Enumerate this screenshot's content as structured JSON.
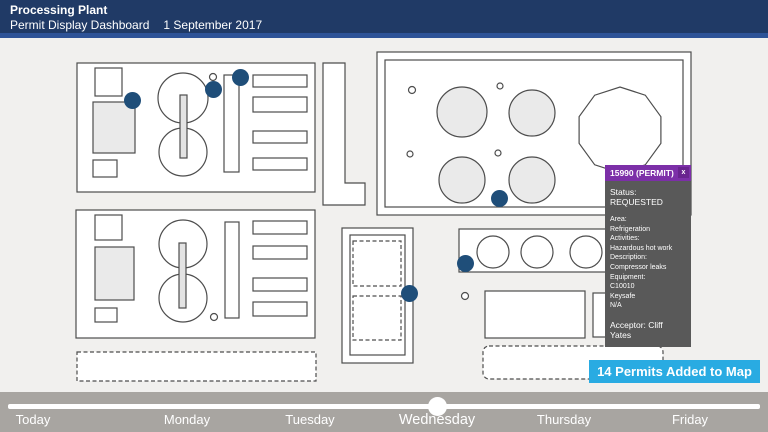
{
  "header": {
    "title": "Processing Plant",
    "subtitle": "Permit Display Dashboard",
    "date": "1 September 2017",
    "filters": [
      {
        "label": "All Units"
      },
      {
        "label": "All Areas"
      },
      {
        "label": "All Types"
      },
      {
        "label": "All Activities"
      }
    ],
    "caret": "▼",
    "go_label": "Go",
    "colors": {
      "bg": "#203A66",
      "accent_strip": "#2E5397",
      "dropdown_bg": "#3E2A50"
    }
  },
  "tooltip": {
    "title": "15990 (PERMIT)",
    "close_label": "x",
    "status": "Status: REQUESTED",
    "detail_lines": [
      "Area:",
      "Refrigeration",
      "Activities:",
      "Hazardous hot work",
      "Description:",
      "Compressor leaks",
      "Equipment:",
      "C10010",
      "Keysafe",
      "N/A"
    ],
    "acceptor": "Acceptor: Cliff Yates",
    "colors": {
      "header_bg": "#7C2FA8",
      "body_bg": "#595959"
    }
  },
  "banner": {
    "text": "14 Permits Added to Map",
    "bg": "#29ABE2"
  },
  "timeline": {
    "days": [
      "Today",
      "Monday",
      "Tuesday",
      "Wednesday",
      "Thursday",
      "Friday"
    ],
    "selected": "Wednesday",
    "bg": "#A8A5A1"
  },
  "map": {
    "marker_color": "#1F4E79",
    "markers": [
      {
        "x": 132,
        "y": 100
      },
      {
        "x": 213,
        "y": 89
      },
      {
        "x": 240,
        "y": 77
      },
      {
        "x": 499,
        "y": 198
      },
      {
        "x": 409,
        "y": 293
      },
      {
        "x": 465,
        "y": 263
      },
      {
        "x": 643,
        "y": 322
      }
    ]
  }
}
